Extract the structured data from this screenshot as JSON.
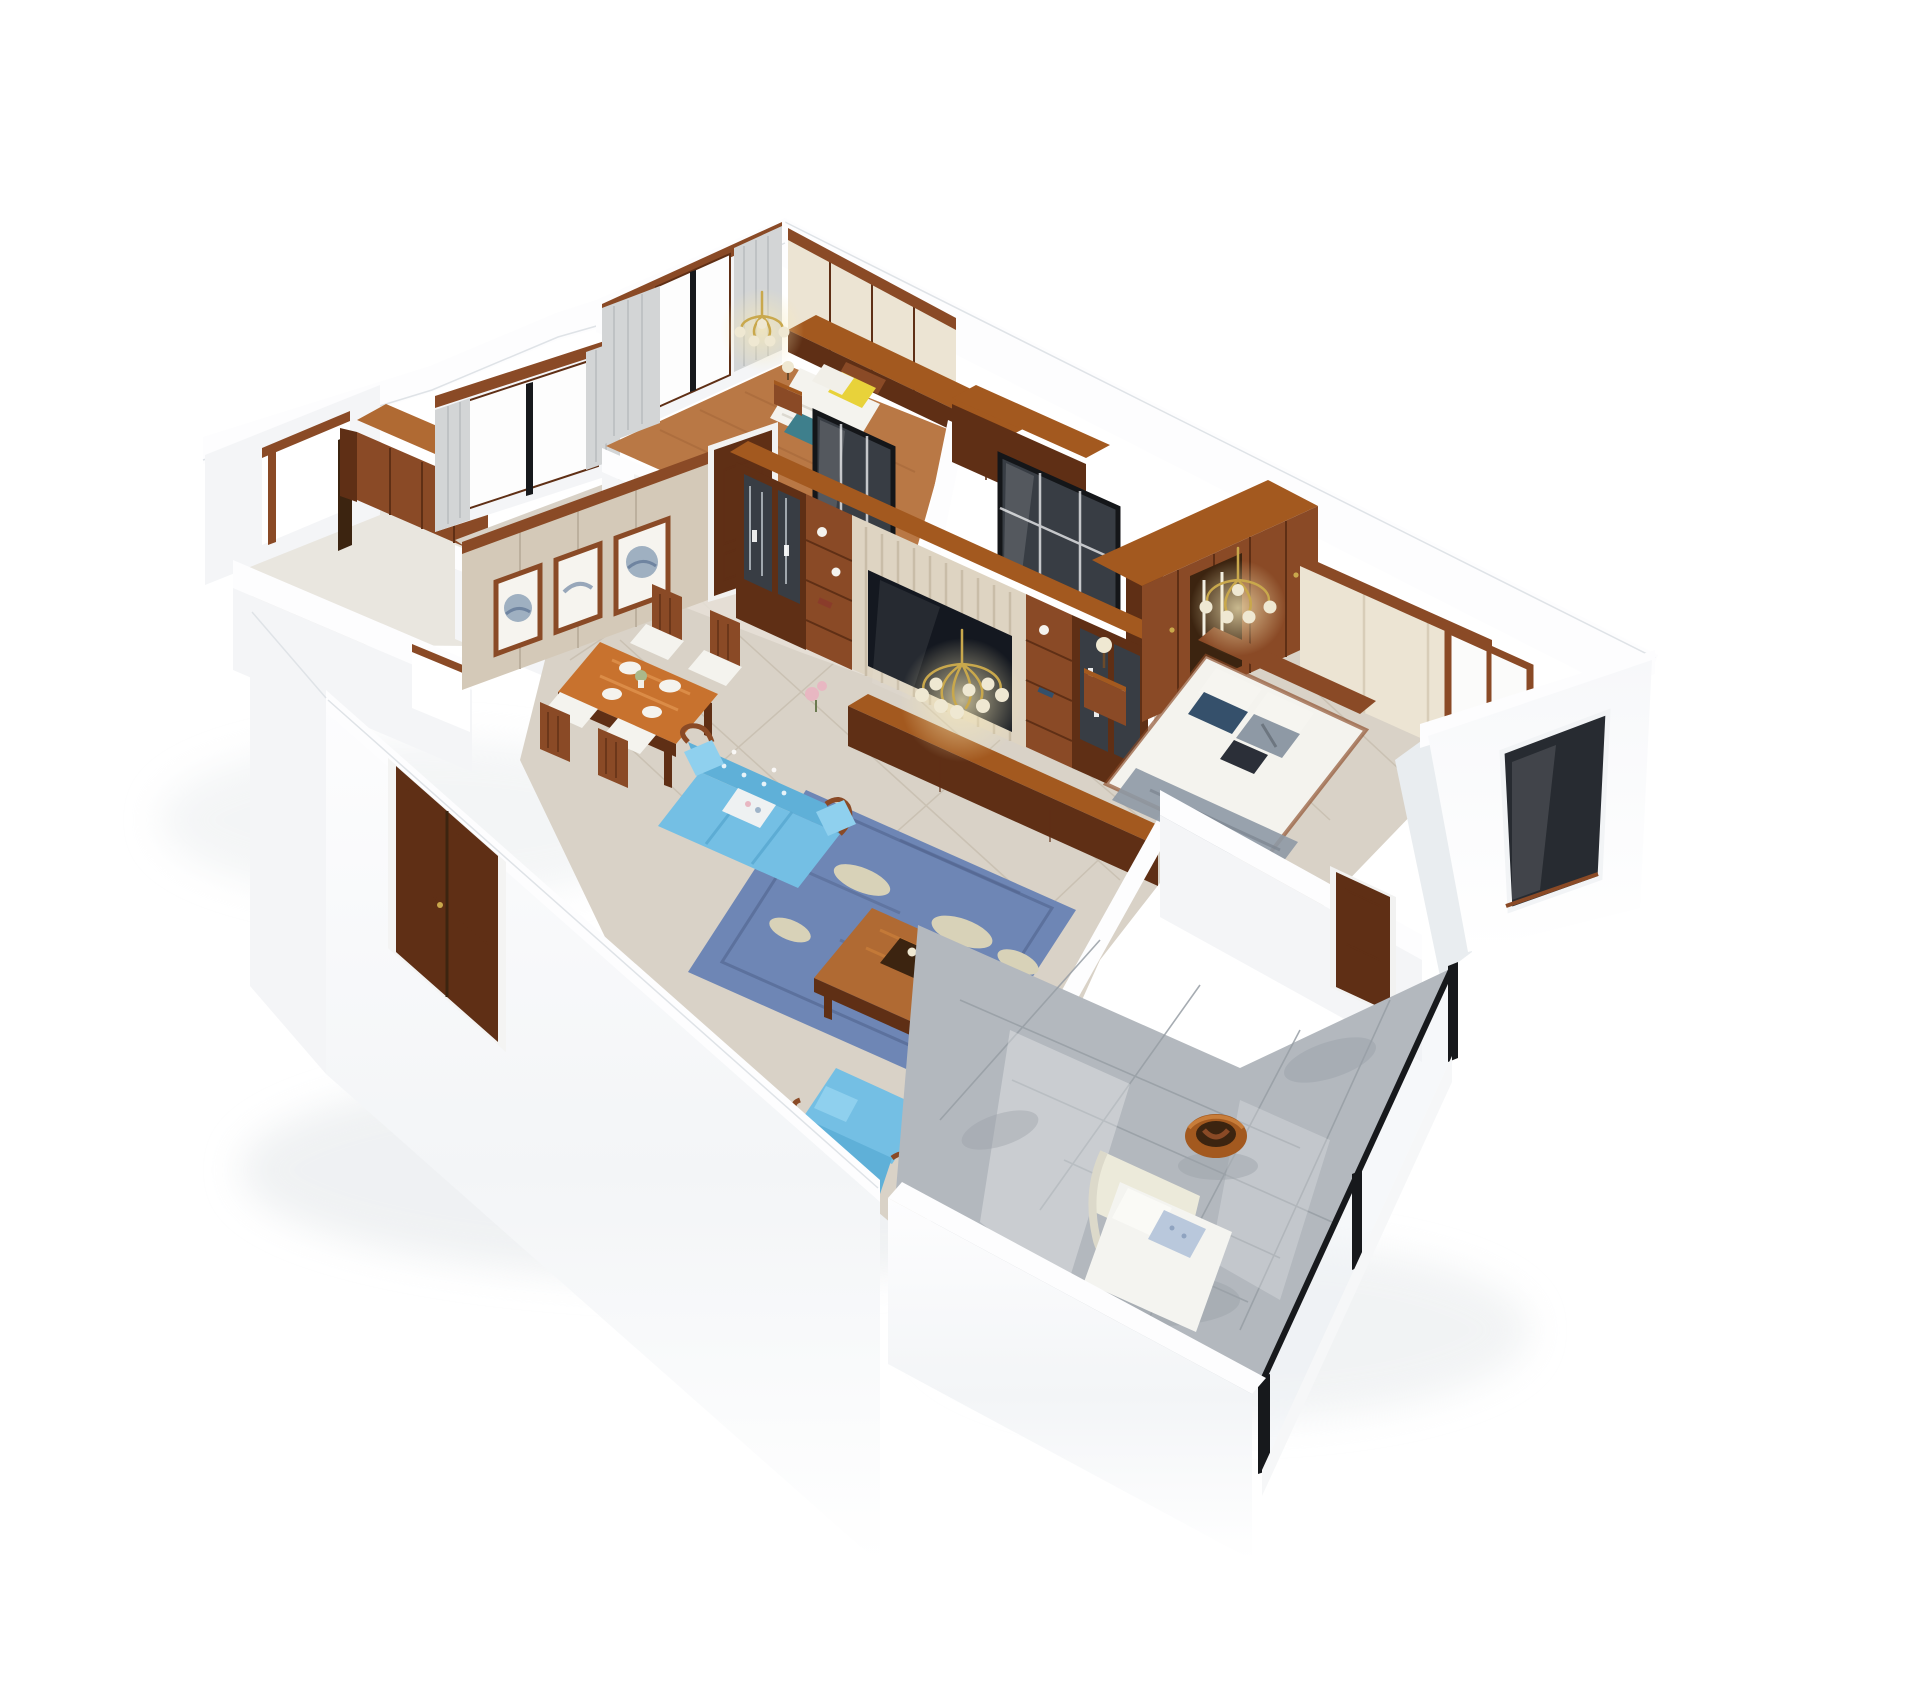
{
  "meta": {
    "title": "3D isometric dollhouse rendering of a furnished apartment floor plan",
    "view": "aerial cutaway perspective, white background, no visible text"
  },
  "palette": {
    "background": "#ffffff",
    "wall_top": "#fdfdfe",
    "wall_face_light": "#f4f5f7",
    "wall_face_shade": "#e9edf0",
    "wall_edge": "#dfe3e7",
    "floor_warm": "#d9d2c7",
    "floor_grout": "#c6bdae",
    "floor_corridor": "#e6e1d7",
    "floor_kitchen": "#e9e6df",
    "floor_bedroom_wood": "#b97845",
    "floor_balcony": "#b3b8be",
    "balcony_grout": "#979da5",
    "wood": "#8a4a26",
    "wood_dark": "#5f2f15",
    "wood_deep": "#3c2410",
    "wood_mid": "#a3591f",
    "wood_light": "#b06a33",
    "wood_table": "#c8722e",
    "cream_panel": "#ece4d3",
    "beige_wall": "#d4c9b8",
    "tv_slats": "#ded4c2",
    "tv_black": "#141820",
    "glass_dark": "#383d44",
    "frame_black": "#17191c",
    "sofa_blue": "#74bfe4",
    "sofa_blue_dark": "#5fb0d8",
    "rug_blue": "#6e86b5",
    "rug_leaf": "#d8d2b8",
    "pillow_yellow": "#e8d23a",
    "pillow_teal": "#3e7f8c",
    "pillow_navy": "#35506b",
    "pillow_gray": "#8e99a5",
    "pillow_dark": "#2b2f38",
    "linen_white": "#f4f3ee",
    "gold": "#c9a84c",
    "lamp_cream": "#efe8d2",
    "art_blue": "#8fa3b8",
    "curtain_gray": "#d3d5d6",
    "shadow": "#e9ecee"
  },
  "rooms": [
    {
      "name": "kitchen",
      "furniture": [
        "wood hutch cabinet",
        "west window with dark frame",
        "south window"
      ]
    },
    {
      "name": "study bedroom",
      "furniture": [
        "wood framed window",
        "gray curtains"
      ]
    },
    {
      "name": "second bedroom",
      "furniture": [
        "bed with yellow pillow",
        "teal throw",
        "nightstand with lamp",
        "brass chandelier",
        "cream built-in wardrobe",
        "wood counter top",
        "curtained window"
      ]
    },
    {
      "name": "bathrooms",
      "furniture": [
        "black framed glass sliding door",
        "second glass sliding door",
        "cloakroom wood wardrobe",
        "wood door"
      ]
    },
    {
      "name": "dining room",
      "furniture": [
        "beige panel wall with three framed artworks",
        "wood door",
        "dining table with place settings",
        "four wood chairs with white cushions"
      ]
    },
    {
      "name": "living room",
      "furniture": [
        "wood media wall with glass display cabinets",
        "cream slat TV panel with black TV",
        "low media console",
        "brass chandelier",
        "blue leaf-pattern rug",
        "wood coffee table with tray and books",
        "blue tufted loveseat",
        "blue armchair",
        "blue chaise near balcony",
        "dark glass slider"
      ]
    },
    {
      "name": "master bedroom",
      "furniture": [
        "wood wardrobe with hanging clothes",
        "cream headboard panel wall",
        "wood framed window",
        "double bed with navy and gray pillows",
        "nightstand with lamp",
        "brass chandelier",
        "wood door"
      ]
    },
    {
      "name": "balcony",
      "furniture": [
        "glossy gray tile floor",
        "white lounge chair with pillows",
        "round wood side table",
        "black framed glass wall"
      ]
    },
    {
      "name": "exterior volume",
      "furniture": [
        "white bay with dark window"
      ]
    }
  ]
}
